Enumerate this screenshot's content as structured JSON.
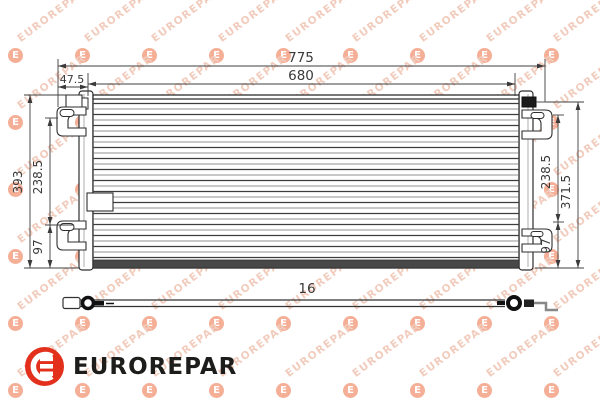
{
  "brand": {
    "name": "EUROREPAR",
    "logo_color": "#e3301d",
    "logo_text_color": "#1d1d1b"
  },
  "watermark": {
    "text": "EUROREPAR",
    "badge_letter": "E"
  },
  "drawing": {
    "dimensions": {
      "top_overall": "775",
      "top_core": "680",
      "top_offset": "47.5",
      "left_total": "393",
      "left_upper": "238.5",
      "left_lower": "97",
      "right_upper": "238.5",
      "right_total": "371.5",
      "right_lower": "97",
      "depth": "16"
    }
  }
}
